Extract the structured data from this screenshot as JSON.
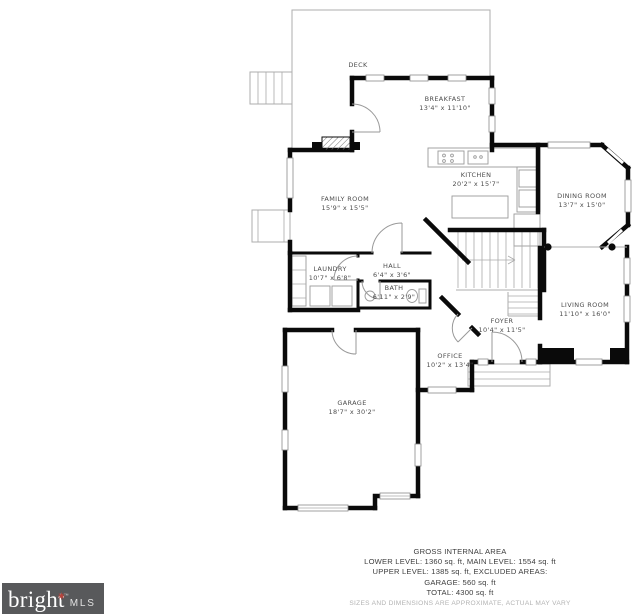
{
  "page": {
    "background": "#ffffff",
    "wall_color": "#0a0a0a",
    "label_color": "#4d4d4d"
  },
  "rooms": [
    {
      "id": "deck",
      "name": "DECK",
      "dims": "",
      "x": 358,
      "y": 67
    },
    {
      "id": "breakfast",
      "name": "BREAKFAST",
      "dims": "13'4\" x 11'10\"",
      "x": 445,
      "y": 101
    },
    {
      "id": "kitchen",
      "name": "KITCHEN",
      "dims": "20'2\" x 15'7\"",
      "x": 476,
      "y": 177
    },
    {
      "id": "dining-room",
      "name": "DINING ROOM",
      "dims": "13'7\" x 15'0\"",
      "x": 582,
      "y": 198
    },
    {
      "id": "family-room",
      "name": "FAMILY ROOM",
      "dims": "15'9\" x 15'5\"",
      "x": 345,
      "y": 201
    },
    {
      "id": "laundry",
      "name": "LAUNDRY",
      "dims": "10'7\" x 6'8\"",
      "x": 330,
      "y": 271
    },
    {
      "id": "hall",
      "name": "HALL",
      "dims": "6'4\" x 3'6\"",
      "x": 392,
      "y": 268
    },
    {
      "id": "bath",
      "name": "BATH",
      "dims": "6'11\" x 2'9\"",
      "x": 394,
      "y": 290
    },
    {
      "id": "living-room",
      "name": "LIVING ROOM",
      "dims": "11'10\" x 16'0\"",
      "x": 585,
      "y": 307
    },
    {
      "id": "foyer",
      "name": "FOYER",
      "dims": "10'4\" x 11'5\"",
      "x": 502,
      "y": 323
    },
    {
      "id": "office",
      "name": "OFFICE",
      "dims": "10'2\" x 13'4\"",
      "x": 450,
      "y": 358
    },
    {
      "id": "garage",
      "name": "GARAGE",
      "dims": "18'7\" x 30'2\"",
      "x": 352,
      "y": 405
    }
  ],
  "footer": {
    "lines": [
      "GROSS INTERNAL AREA",
      "LOWER LEVEL: 1360 sq. ft, MAIN LEVEL: 1554 sq. ft",
      "UPPER LEVEL: 1385 sq. ft, EXCLUDED AREAS:",
      "GARAGE: 560 sq. ft",
      "TOTAL: 4300 sq. ft"
    ],
    "disclaimer": "SIZES AND DIMENSIONS ARE APPROXIMATE, ACTUAL MAY VARY"
  },
  "logo": {
    "brand": "bright",
    "star": "✷",
    "trademark": "™",
    "suffix": "MLS",
    "bg_color": "#58595b",
    "star_color": "#b5443c",
    "text_color": "#ffffff"
  }
}
